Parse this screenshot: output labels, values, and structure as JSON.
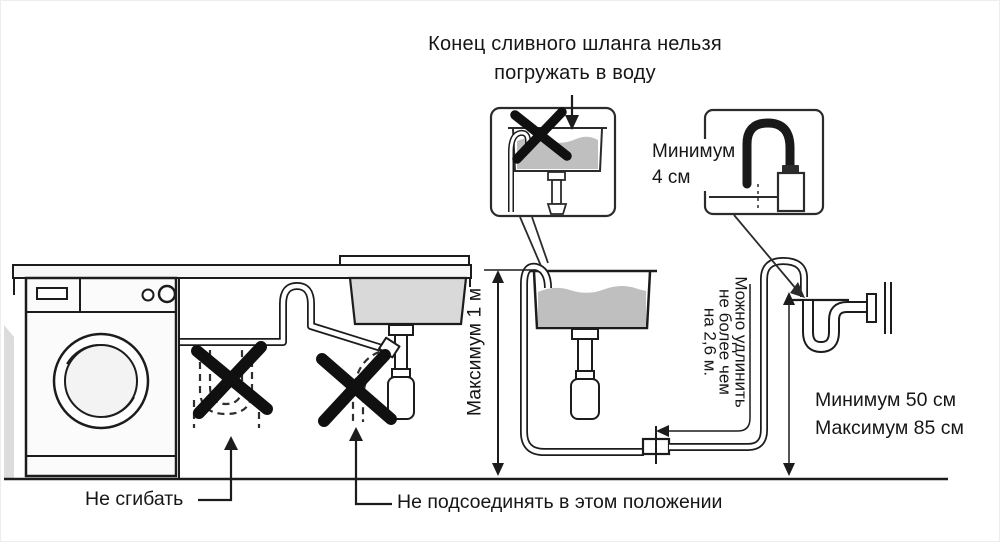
{
  "title": {
    "line1": "Конец сливного шланга нельзя",
    "line2": "погружать в воду"
  },
  "callouts": {
    "min_insert": {
      "line1": "Минимум",
      "line2": "4 см"
    },
    "max_height": "Максимум 1 м",
    "extension": {
      "line1": "Можно удлинить",
      "line2": "не более чем",
      "line3": "на 2,6 м."
    },
    "standpipe_min": "Минимум 50 см",
    "standpipe_max": "Максимум 85 см",
    "no_bend": "Не сгибать",
    "no_connect": "Не подсоединять в этом положении"
  },
  "icons": {
    "prohibition": "x-cross-icon",
    "pointer": "arrow-icon"
  },
  "colors": {
    "line": "#1c1c1c",
    "water": "#bfbfbf",
    "sink_fill": "#d9d9d9",
    "counter_fill": "#f6f6f6",
    "prohibition": "#101010",
    "background": "#ffffff"
  }
}
